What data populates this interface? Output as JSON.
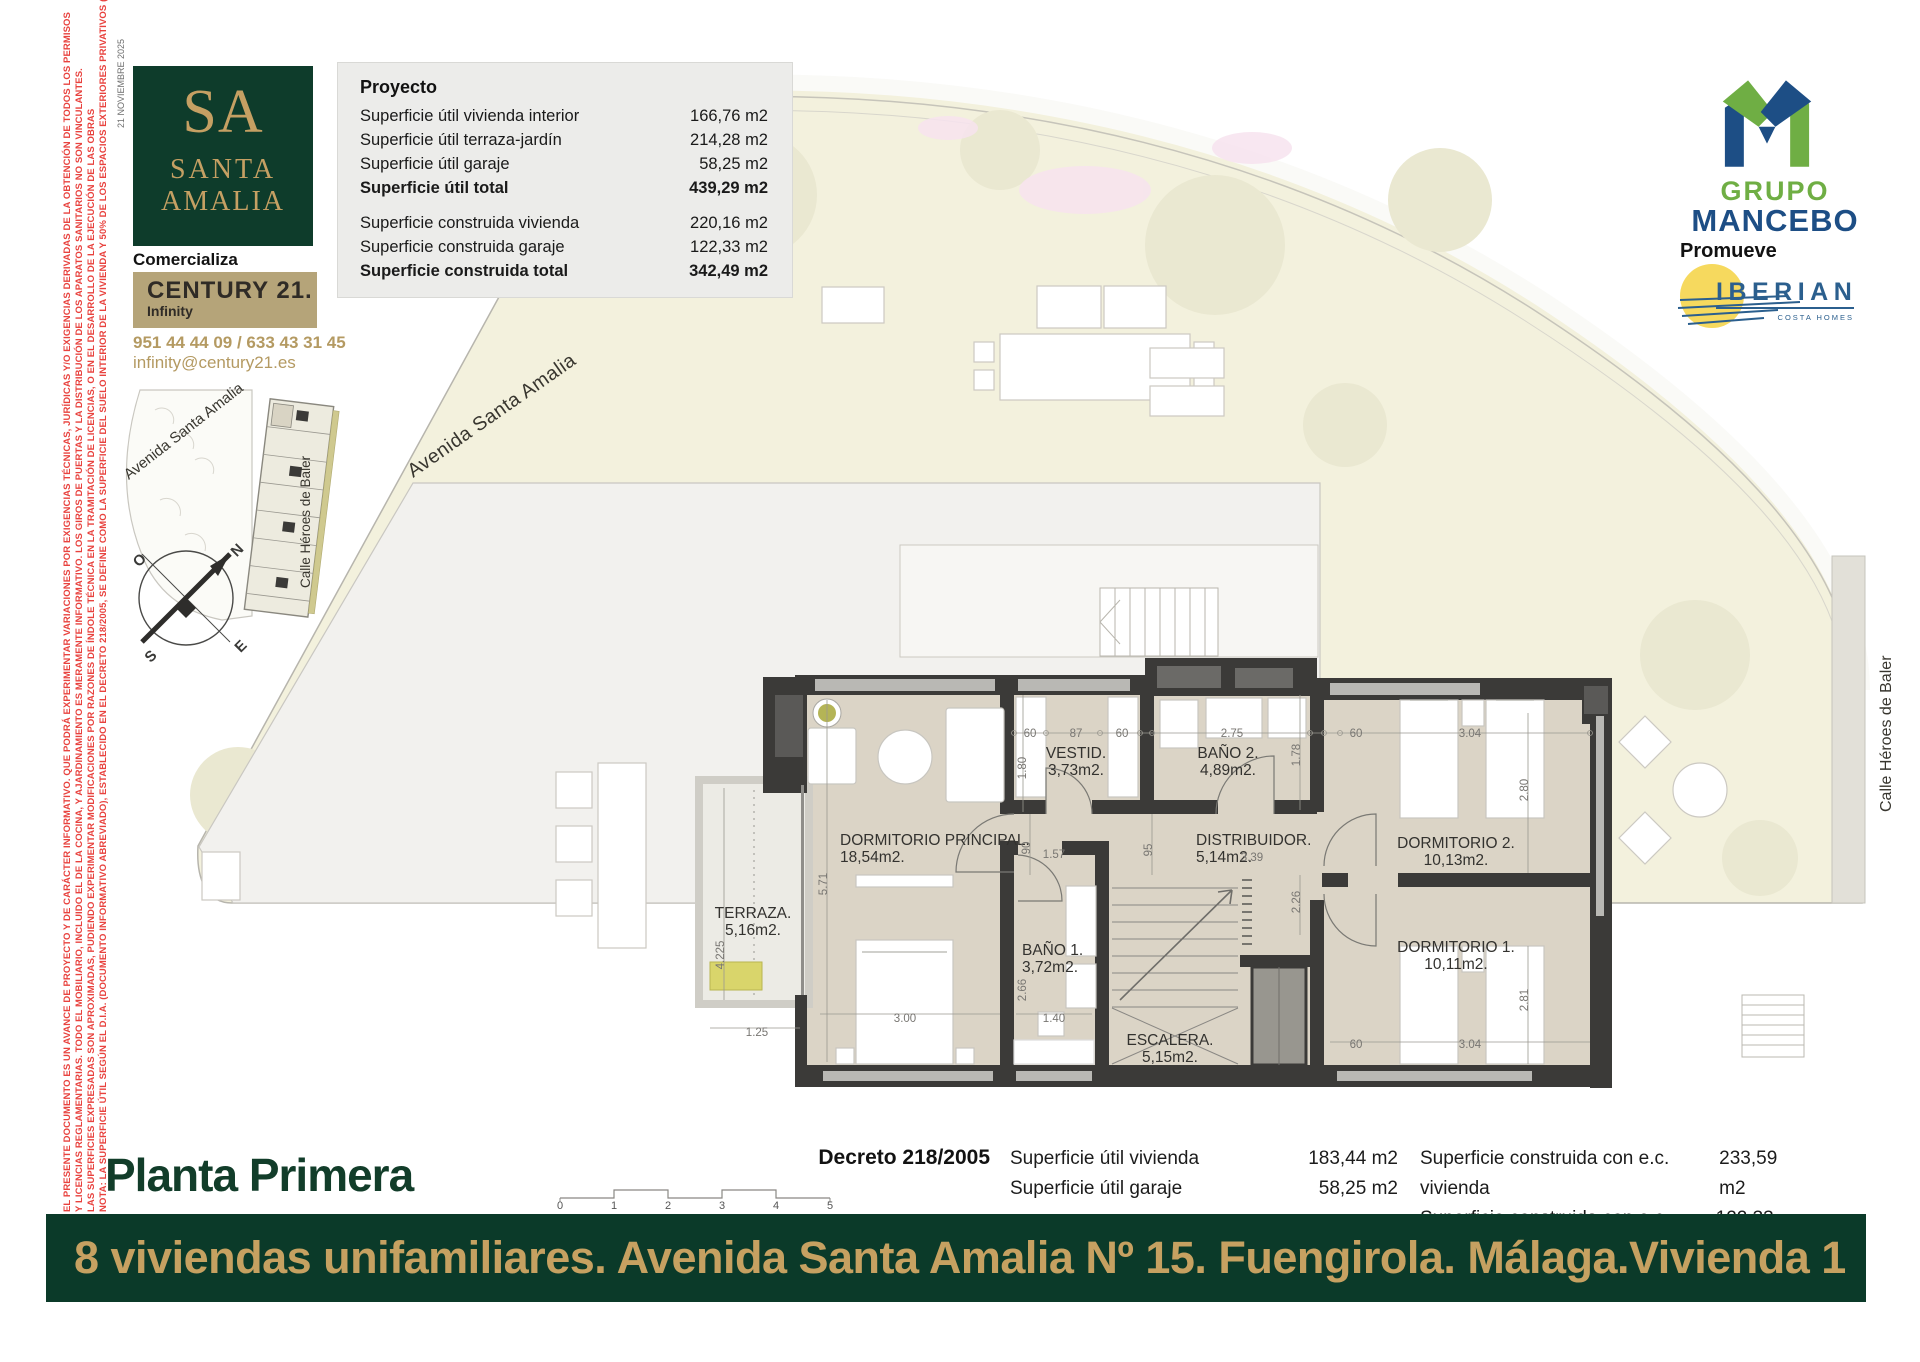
{
  "meta": {
    "date_note": "21 NOVIEMBRE 2025"
  },
  "disclaimer_lines": [
    "EL PRESENTE DOCUMENTO ES UN AVANCE DE PROYECTO Y DE CARÁCTER INFORMATIVO. QUE PODRÁ EXPERIMENTAR VARIACIONES POR EXIGENCIAS TÉCNICAS, JURÍDICAS Y/O EXIGENCIAS DERIVADAS DE LA OBTENCIÓN DE TODOS LOS PERMISOS",
    "Y LICENCIAS REGLAMENTARIAS. TODO EL MOBILIARIO, INCLUIDO EL DE LA COCINA, Y AJARDINAMIENTO ES MERAMENTE INFORMATIVO. LOS GIROS DE PUERTAS Y LA DISTRIBUCIÓN DE LOS APARATOS SANITARIOS NO SON VINCULANTES.",
    "LAS SUPERFICIES EXPRESADAS SON APROXIMADAS, PUDIENDO EXPERIMENTAR MODIFICACIONES POR RAZONES DE ÍNDOLE TÉCNICA EN LA TRAMITACIÓN DE LICENCIAS, O EN EL DESARROLLO DE LA EJECUCIÓN DE LAS OBRAS",
    "NOTA: LA SUPERFICIE ÚTIL SEGÚN EL D.I.A. (DOCUMENTO INFORMATIVO ABREVIADO), ESTABLECIDO EN EL DECRETO 218/2005, SE DEFINE COMO LA SUPERFICIE DEL SUELO INTERIOR DE LA VIVIENDA Y 50% DE LOS ESPACIOS EXTERIORES PRIVATIVOS (LIMITÁNDOSE AL 10% DE LA ÚTIL INTERIOR)"
  ],
  "branding": {
    "sa_monogram": "SA",
    "sa_line1": "SANTA",
    "sa_line2": "AMALIA",
    "comercializa": "Comercializa",
    "century": "CENTURY 21.",
    "century_sub": "Infinity",
    "phone": "951 44 44 09 / 633 43 31 45",
    "email": "infinity@century21.es"
  },
  "developer": {
    "grupo": "GRUPO",
    "mancebo": "MANCEBO",
    "promueve": "Promueve",
    "iberian": "IBERIAN",
    "costa_homes": "COSTA HOMES"
  },
  "project_table": {
    "title": "Proyecto",
    "rows": [
      {
        "label": "Superficie útil vivienda interior",
        "value": "166,76 m2",
        "bold": false,
        "gap": false
      },
      {
        "label": "Superficie útil terraza-jardín",
        "value": "214,28 m2",
        "bold": false,
        "gap": false
      },
      {
        "label": "Superficie útil garaje",
        "value": "58,25 m2",
        "bold": false,
        "gap": false
      },
      {
        "label": "Superficie útil total",
        "value": "439,29 m2",
        "bold": true,
        "gap": false
      },
      {
        "label": "Superficie construida vivienda",
        "value": "220,16 m2",
        "bold": false,
        "gap": true
      },
      {
        "label": "Superficie construida garaje",
        "value": "122,33 m2",
        "bold": false,
        "gap": false
      },
      {
        "label": "Superficie construida total",
        "value": "342,49 m2",
        "bold": true,
        "gap": false
      }
    ]
  },
  "compass": {
    "n": "N",
    "s": "S",
    "e": "E",
    "o": "O"
  },
  "streets": {
    "avenue": "Avenida Santa Amalia",
    "street": "Calle Héroes de Baler"
  },
  "plan": {
    "rooms": [
      {
        "name": "DORMITORIO PRINCIPAL.",
        "area": "18,54m2.",
        "x": 840,
        "y": 845,
        "anchor": "start"
      },
      {
        "name": "VESTID.",
        "area": "3,73m2.",
        "x": 1076,
        "y": 758,
        "anchor": "middle"
      },
      {
        "name": "BAÑO 2.",
        "area": "4,89m2.",
        "x": 1228,
        "y": 758,
        "anchor": "middle"
      },
      {
        "name": "DISTRIBUIDOR.",
        "area": "5,14m2.",
        "x": 1196,
        "y": 845,
        "anchor": "start"
      },
      {
        "name": "DORMITORIO 2.",
        "area": "10,13m2.",
        "x": 1456,
        "y": 848,
        "anchor": "middle"
      },
      {
        "name": "DORMITORIO 1.",
        "area": "10,11m2.",
        "x": 1456,
        "y": 952,
        "anchor": "middle"
      },
      {
        "name": "BAÑO 1.",
        "area": "3,72m2.",
        "x": 1022,
        "y": 955,
        "anchor": "start"
      },
      {
        "name": "ESCALERA.",
        "area": "5,15m2.",
        "x": 1170,
        "y": 1045,
        "anchor": "middle"
      },
      {
        "name": "TERRAZA.",
        "area": "5,16m2.",
        "x": 753,
        "y": 918,
        "anchor": "middle"
      }
    ],
    "dims": [
      {
        "t": "60",
        "x": 1030,
        "y": 737,
        "rot": false
      },
      {
        "t": "87",
        "x": 1076,
        "y": 737,
        "rot": false
      },
      {
        "t": "60",
        "x": 1122,
        "y": 737,
        "rot": false
      },
      {
        "t": "2.75",
        "x": 1232,
        "y": 737,
        "rot": false
      },
      {
        "t": "60",
        "x": 1356,
        "y": 737,
        "rot": false
      },
      {
        "t": "3.04",
        "x": 1470,
        "y": 737,
        "rot": false
      },
      {
        "t": "1.80",
        "x": 1026,
        "y": 768,
        "rot": true
      },
      {
        "t": "1.78",
        "x": 1300,
        "y": 755,
        "rot": true
      },
      {
        "t": "2.80",
        "x": 1528,
        "y": 790,
        "rot": true
      },
      {
        "t": "90",
        "x": 1030,
        "y": 848,
        "rot": true
      },
      {
        "t": "1.57",
        "x": 1054,
        "y": 858,
        "rot": false
      },
      {
        "t": "95",
        "x": 1152,
        "y": 850,
        "rot": true
      },
      {
        "t": "3.39",
        "x": 1252,
        "y": 861,
        "rot": false
      },
      {
        "t": "2.26",
        "x": 1300,
        "y": 902,
        "rot": true
      },
      {
        "t": "5.71",
        "x": 827,
        "y": 884,
        "rot": true
      },
      {
        "t": "4.225",
        "x": 724,
        "y": 955,
        "rot": true
      },
      {
        "t": "2.66",
        "x": 1026,
        "y": 990,
        "rot": true
      },
      {
        "t": "3.00",
        "x": 905,
        "y": 1022,
        "rot": false
      },
      {
        "t": "1.40",
        "x": 1054,
        "y": 1022,
        "rot": false
      },
      {
        "t": "1.25",
        "x": 757,
        "y": 1036,
        "rot": false
      },
      {
        "t": "60",
        "x": 1356,
        "y": 1048,
        "rot": false
      },
      {
        "t": "3.04",
        "x": 1470,
        "y": 1048,
        "rot": false
      },
      {
        "t": "2.81",
        "x": 1528,
        "y": 1000,
        "rot": true
      }
    ]
  },
  "footer": {
    "floor_title": "Planta Primera",
    "decreto": "Decreto 218/2005",
    "scale_ticks": [
      "0",
      "1",
      "2",
      "3",
      "4",
      "5"
    ],
    "left_col": [
      {
        "label": "Superficie útil vivienda",
        "value": "183,44 m2"
      },
      {
        "label": "Superficie útil garaje",
        "value": "58,25 m2"
      }
    ],
    "right_col": [
      {
        "label": "Superficie construida con e.c. vivienda",
        "value": "233,59 m2"
      },
      {
        "label": "Superficie construida con e.c. garaje",
        "value": "122,33 m2"
      }
    ]
  },
  "banner": {
    "left": "8 viviendas unifamiliares. Avenida Santa Amalia Nº 15. Fuengirola. Málaga.",
    "right": "Vivienda 1"
  },
  "colors": {
    "brand_green": "#0e3c2b",
    "brand_gold": "#c6a161",
    "century_tan": "#b5a479",
    "disclaimer_red": "#e8423e",
    "grupo_green": "#6fae44",
    "grupo_blue": "#1d4e85",
    "iberian_yellow": "#f6d95e",
    "garden_cream": "#f3f1dd",
    "wall_dark": "#3b3a38",
    "floor_beige": "#dbd4c6"
  }
}
